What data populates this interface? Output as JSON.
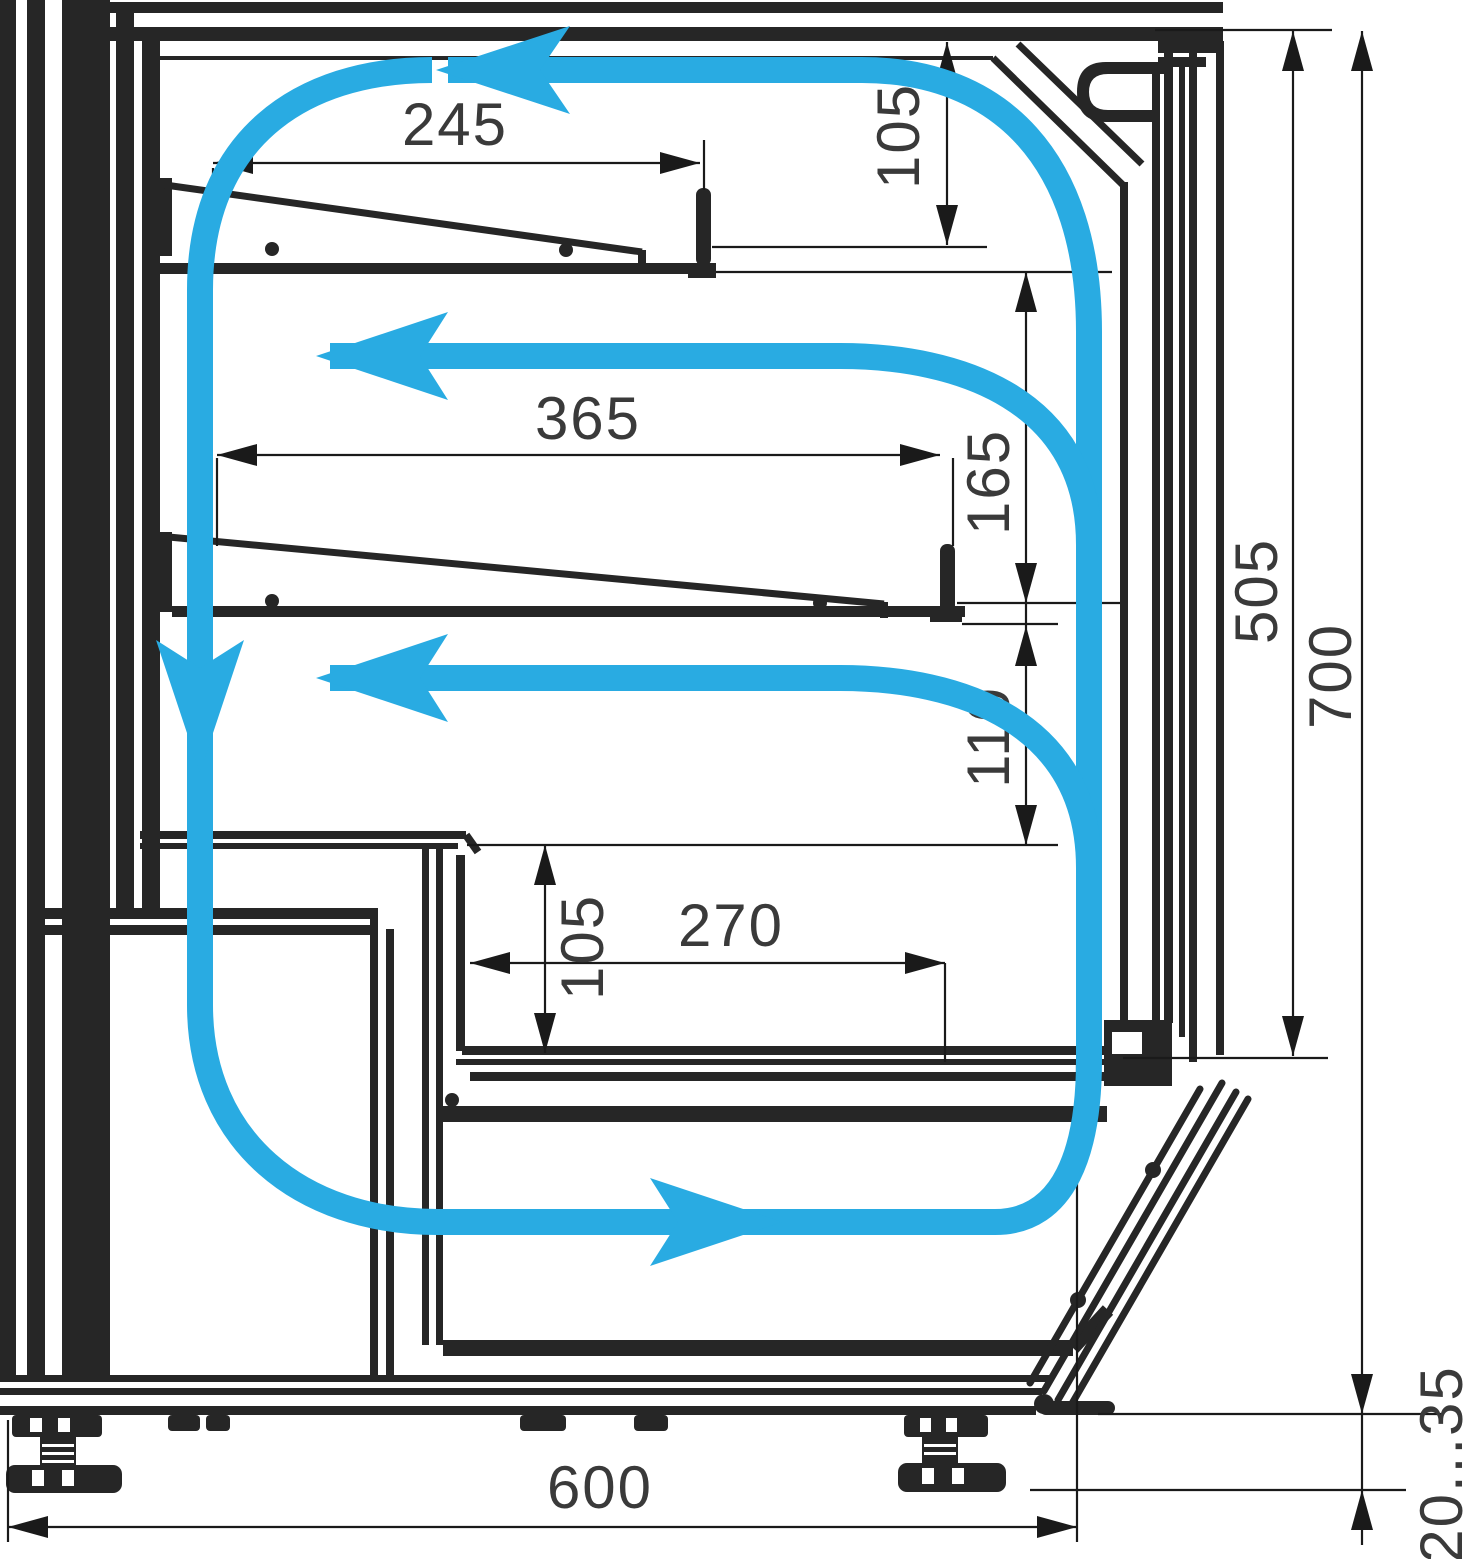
{
  "drawing": {
    "type": "technical-cross-section",
    "subject": "refrigerated display case side section with air circulation",
    "background": "#ffffff",
    "structure_color": "#262626",
    "dimension_line_color": "#1a1a1a",
    "text_color": "#3a3a3a",
    "airflow_color": "#29ABE2",
    "dimensions": {
      "shelf1_depth": "245",
      "canopy_to_shelf1": "105",
      "shelf2_depth": "365",
      "shelf1_to_shelf2": "165",
      "shelf2_to_counter": "110",
      "counter_to_deck": "105",
      "deck_depth": "270",
      "inner_height": "505",
      "overall_height": "700",
      "overall_depth": "600",
      "foot_adjustment": "20...35"
    }
  }
}
